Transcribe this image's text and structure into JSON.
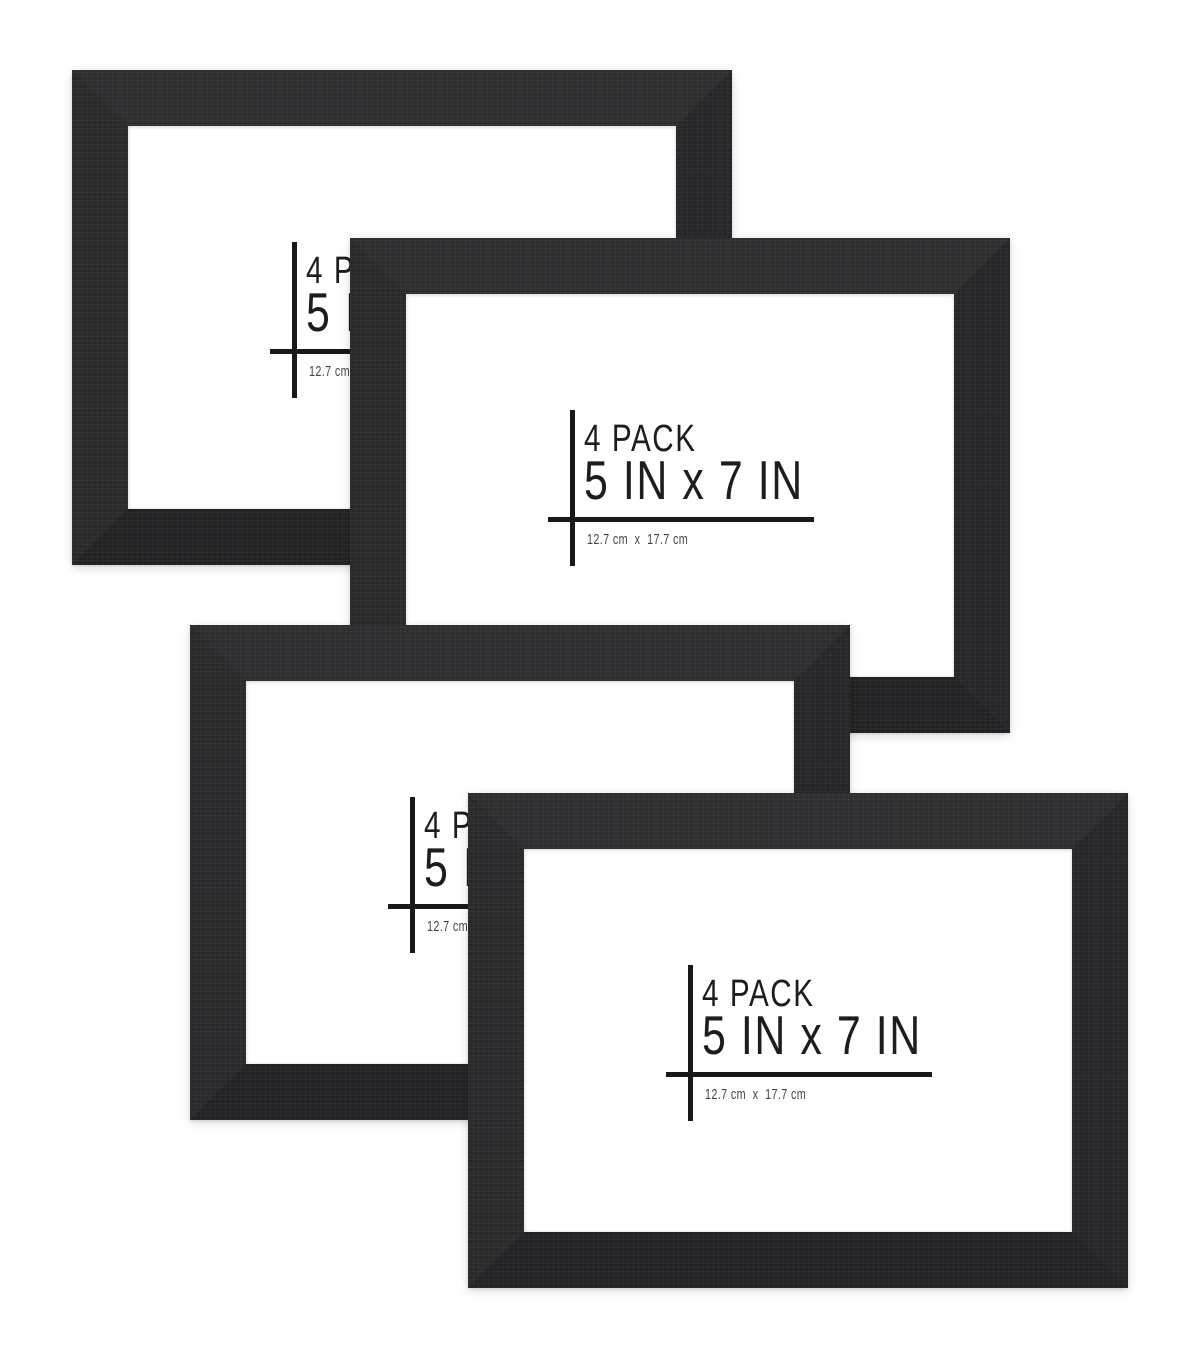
{
  "image": {
    "kind": "product-photo",
    "background_color": "#ffffff",
    "frame_color": "#28282a",
    "mat_color": "#ffffff",
    "frame_count": 4
  },
  "label": {
    "pack": "4 PACK",
    "size": "5 IN x 7 IN",
    "metric": "12.7 cm  x  17.7 cm"
  },
  "frames": [
    {
      "id": "frame-top-left"
    },
    {
      "id": "frame-top-right"
    },
    {
      "id": "frame-bottom-left"
    },
    {
      "id": "frame-bottom-right"
    }
  ]
}
